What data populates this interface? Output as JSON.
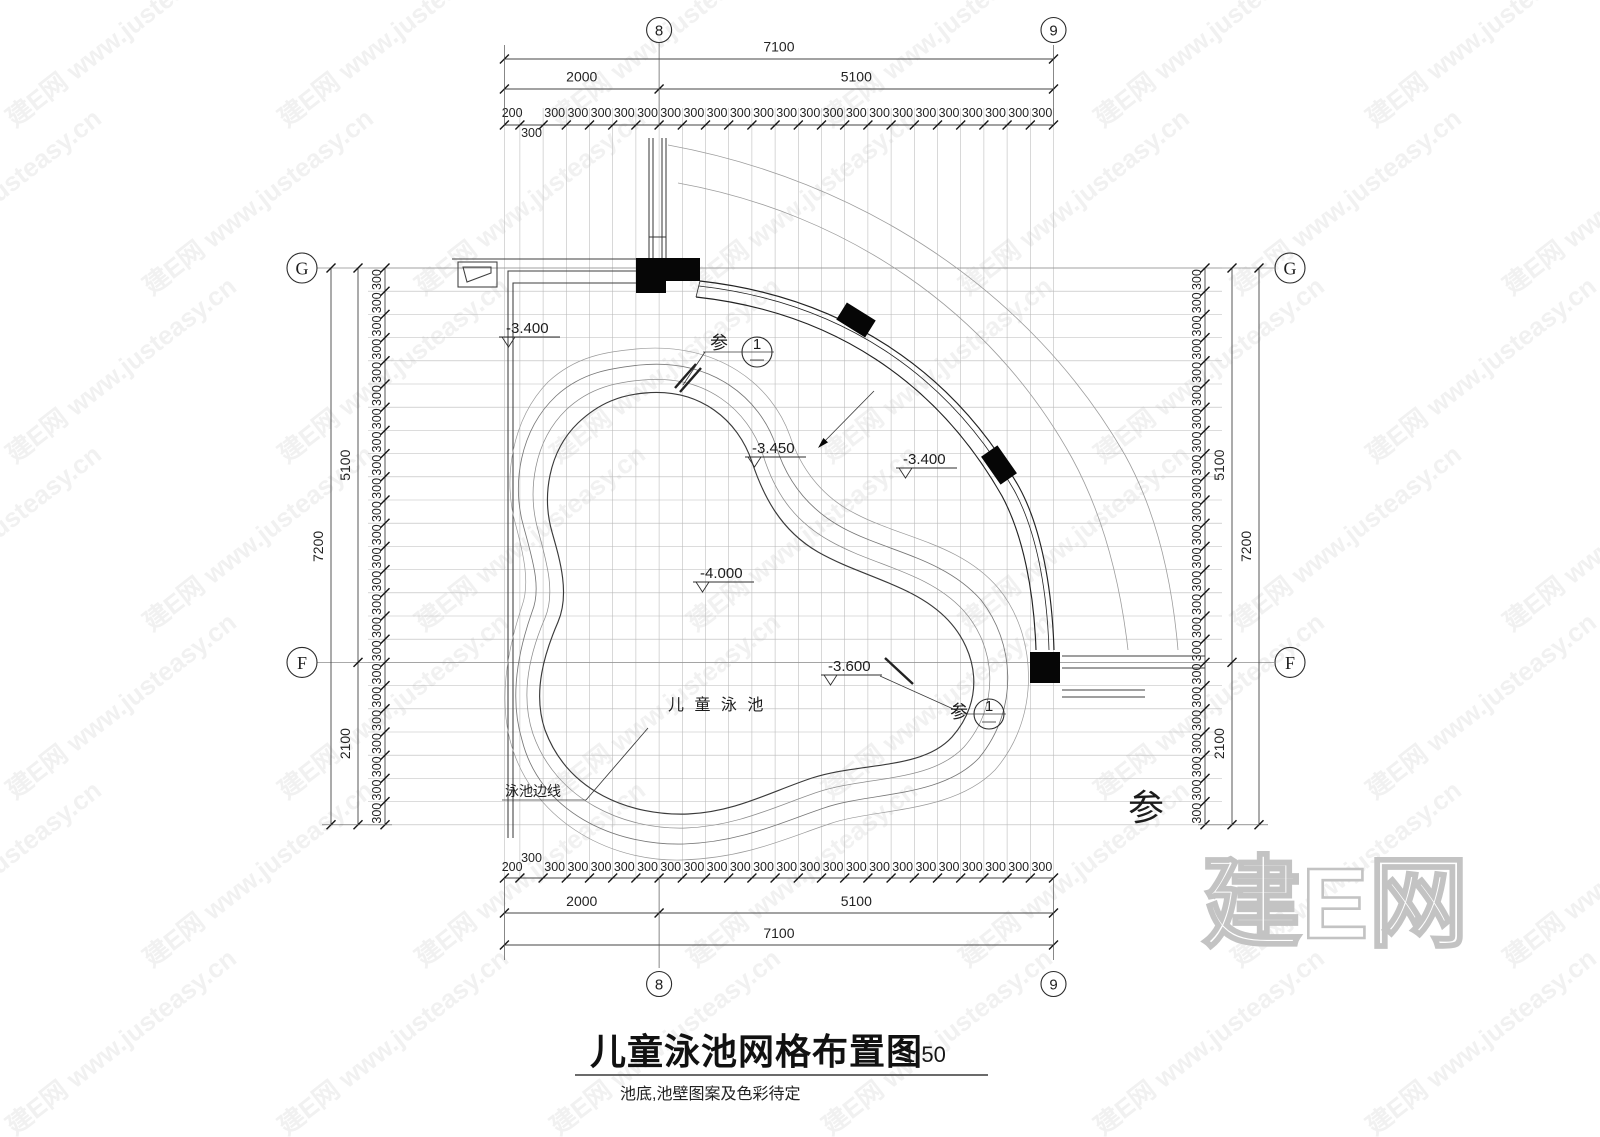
{
  "watermark": {
    "tile_text": "建E网 www.justeasy.cn",
    "logo_text": "建E网"
  },
  "grid_axes": {
    "top": [
      "8",
      "9"
    ],
    "bottom": [
      "8",
      "9"
    ],
    "left": [
      "G",
      "F"
    ],
    "right": [
      "G",
      "F"
    ]
  },
  "dims": {
    "top": {
      "total": "7100",
      "seg_a": "2000",
      "seg_b": "5100",
      "first": "200",
      "step": "300",
      "steps_a": 6,
      "steps_b": 17
    },
    "bottom": {
      "total": "7100",
      "seg_a": "2000",
      "seg_b": "5100",
      "first": "200",
      "step": "300"
    },
    "left": {
      "total": "7200",
      "seg_a": "5100",
      "seg_b": "2100",
      "step": "300",
      "steps": 24
    },
    "right": {
      "total": "7200",
      "seg_a": "5100",
      "seg_b": "2100",
      "step": "300",
      "steps": 24
    }
  },
  "elevations": [
    {
      "label": "-3.400"
    },
    {
      "label": "-3.450"
    },
    {
      "label": "-3.400"
    },
    {
      "label": "-4.000"
    },
    {
      "label": "-3.600"
    }
  ],
  "callouts": {
    "ref": "参",
    "num": "1",
    "big_ref": "参"
  },
  "labels": {
    "pool_name": "儿 童 泳 池",
    "pool_edge": "泳池边线"
  },
  "title": {
    "text": "儿童泳池网格布置图",
    "scale": "1:50",
    "note": "池底,池壁图案及色彩待定"
  }
}
